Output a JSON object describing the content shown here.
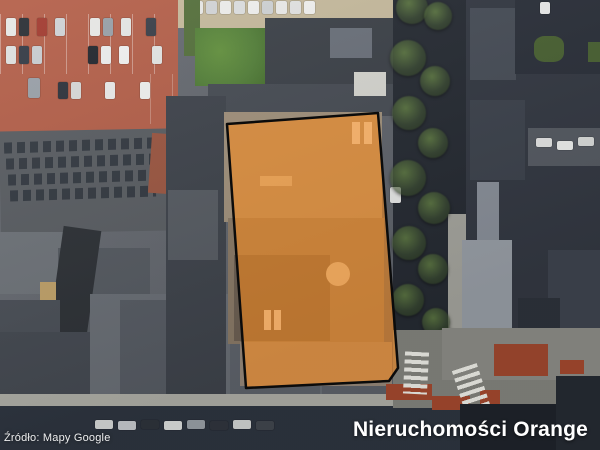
{
  "map": {
    "type": "satellite-aerial-view",
    "attribution": "Źródło: Mapy Google",
    "brand": "Nieruchomości Orange",
    "parcel": {
      "points": "227,124 378,113 398,368 389,381 246,388",
      "fill": "#FF8C1A",
      "fill_opacity": 0.55,
      "outline": "#0B0B0B"
    },
    "colors": {
      "brand_text": "#FFFFFF",
      "attribution_text": "#FFFFFF",
      "parking_lot_red": "#B4604A",
      "lawn_green": "#5D8A3C",
      "street_dark": "#2E3540",
      "sidewalk": "#B0B0A8",
      "bike_lane_red": "#A64A2F"
    }
  }
}
